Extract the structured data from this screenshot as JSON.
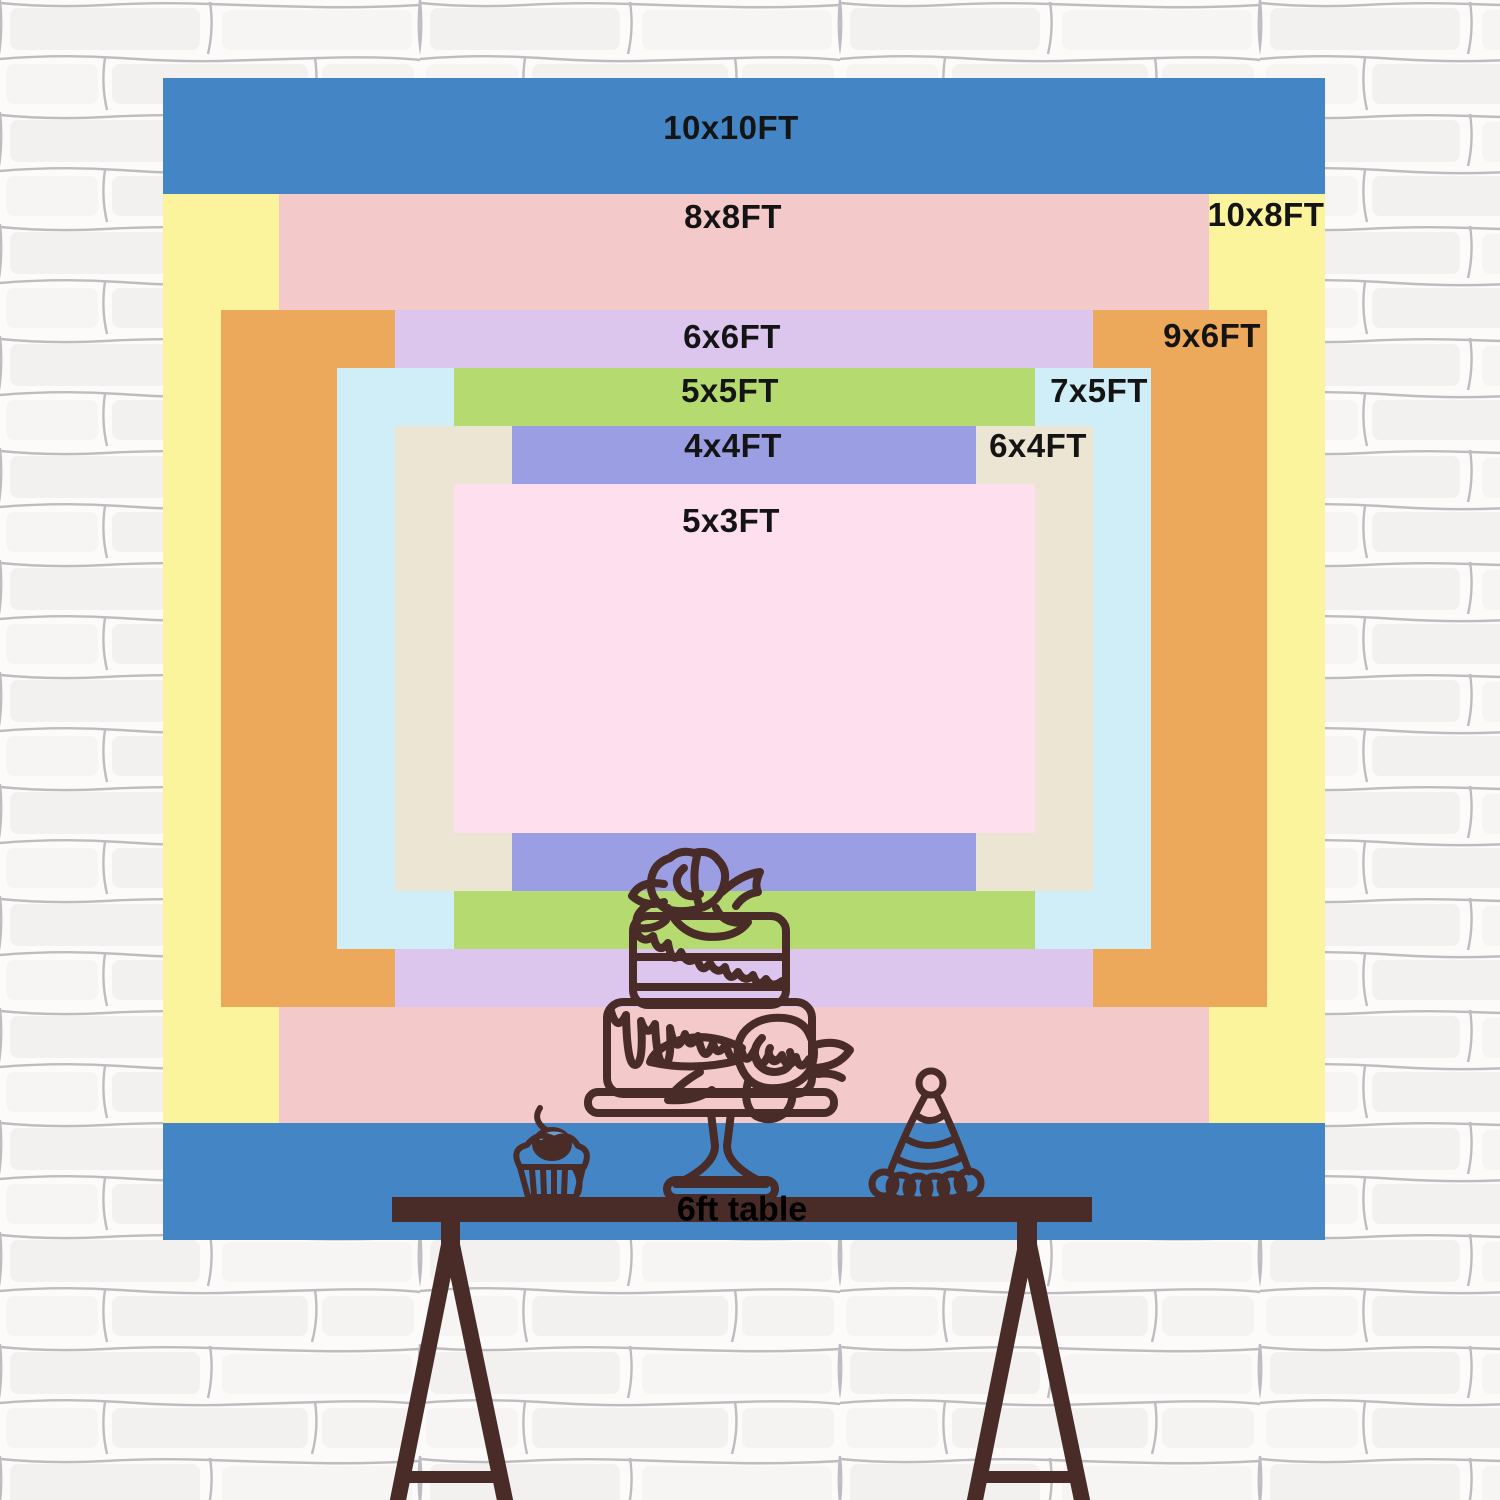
{
  "chart": {
    "type": "backdrop-size-comparison",
    "unit": "FT",
    "sizes": [
      {
        "id": "10x10",
        "label": "10x10FT",
        "width_ft": 10,
        "height_ft": 10,
        "color": "#4486c5"
      },
      {
        "id": "10x8",
        "label": "10x8FT",
        "width_ft": 10,
        "height_ft": 8,
        "color": "#fbf49c"
      },
      {
        "id": "8x8",
        "label": "8x8FT",
        "width_ft": 8,
        "height_ft": 8,
        "color": "#f4c9ca"
      },
      {
        "id": "9x6",
        "label": "9x6FT",
        "width_ft": 9,
        "height_ft": 6,
        "color": "#eca95c"
      },
      {
        "id": "6x6",
        "label": "6x6FT",
        "width_ft": 6,
        "height_ft": 6,
        "color": "#dcc6ee"
      },
      {
        "id": "7x5",
        "label": "7x5FT",
        "width_ft": 7,
        "height_ft": 5,
        "color": "#cfeef8"
      },
      {
        "id": "5x5",
        "label": "5x5FT",
        "width_ft": 5,
        "height_ft": 5,
        "color": "#b4da70"
      },
      {
        "id": "6x4",
        "label": "6x4FT",
        "width_ft": 6,
        "height_ft": 4,
        "color": "#ece5d4"
      },
      {
        "id": "4x4",
        "label": "4x4FT",
        "width_ft": 4,
        "height_ft": 4,
        "color": "#9c9ee4"
      },
      {
        "id": "5x3",
        "label": "5x3FT",
        "width_ft": 5,
        "height_ft": 3,
        "color": "#fddfee"
      }
    ],
    "label_color": "#141414"
  },
  "table": {
    "label": "6ft table"
  },
  "illustration": {
    "line_color": "#492b28",
    "items": [
      "tiered-cake-on-stand",
      "cupcake-with-cherry",
      "party-hat",
      "trestle-table"
    ]
  },
  "wall": {
    "style": "white-brick",
    "mortar_color": "#8b8790"
  }
}
